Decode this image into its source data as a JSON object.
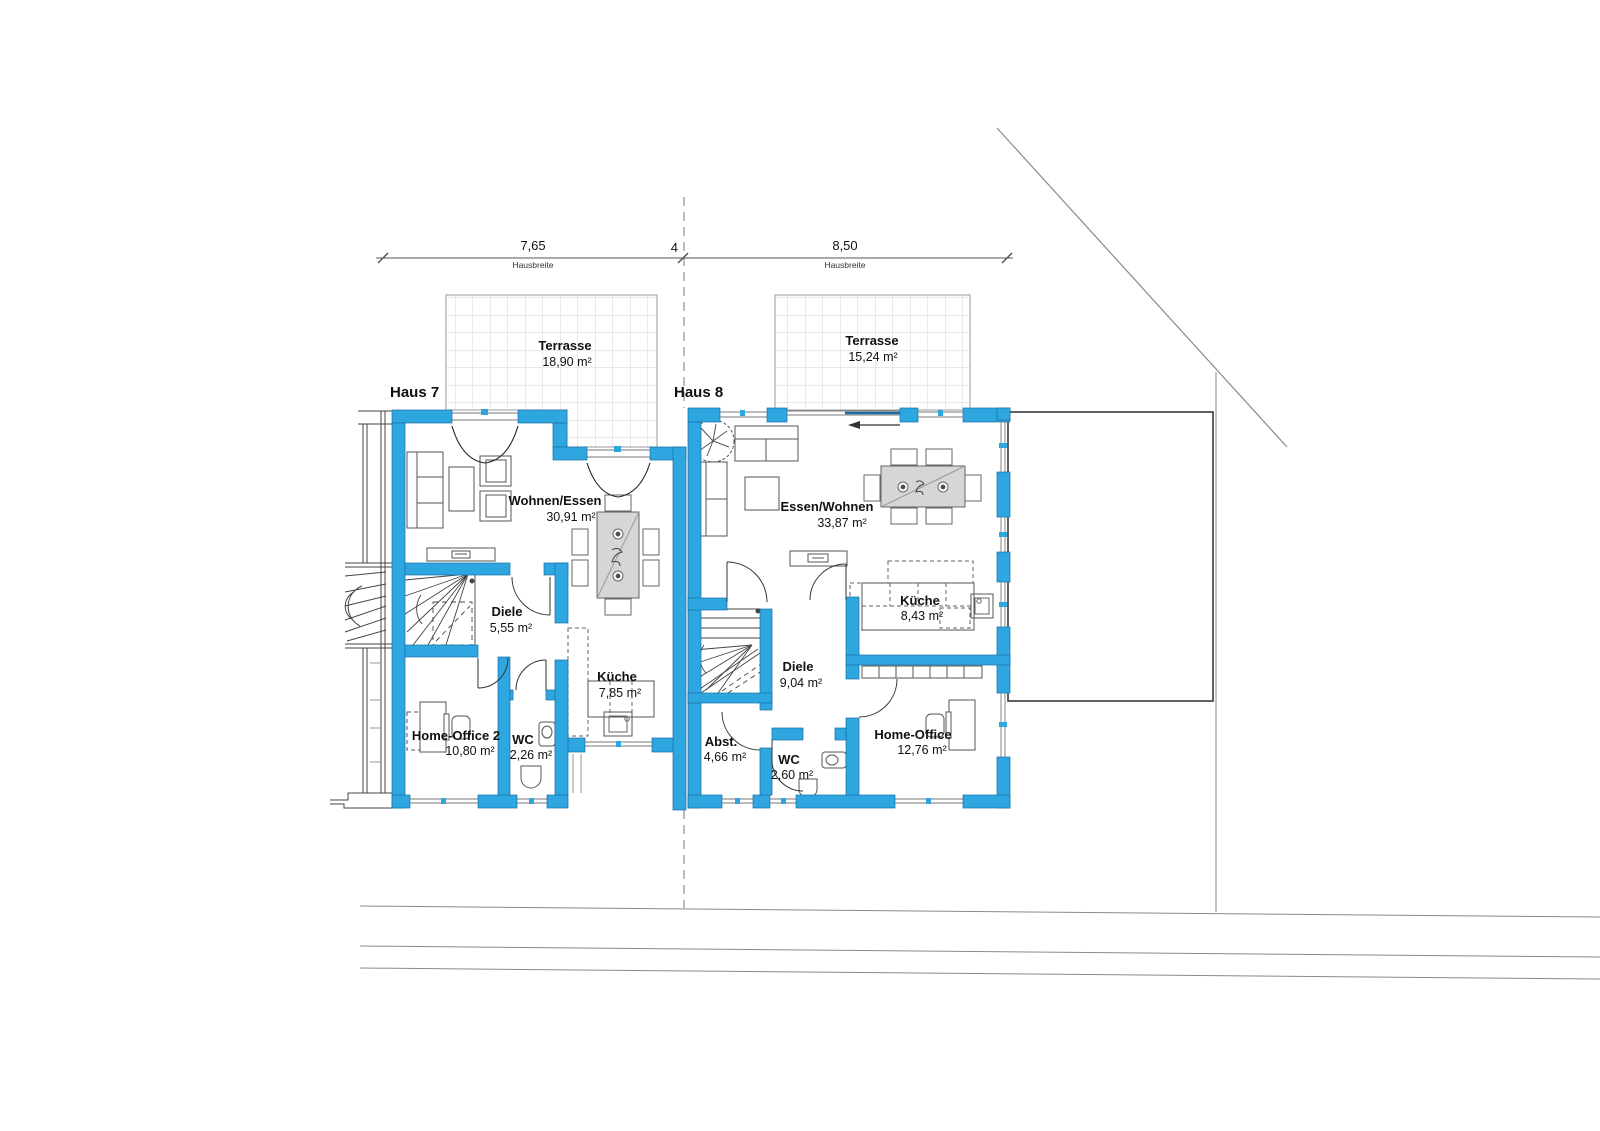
{
  "plan": {
    "dimensions": {
      "left": "7,65",
      "middle": "4",
      "right": "8,50",
      "left_sublabel": "Hausbreite",
      "right_sublabel": "Hausbreite"
    },
    "houses": [
      {
        "id": "haus7",
        "label": "Haus 7",
        "terrace": {
          "name": "Terrasse",
          "area": "18,90 m²"
        },
        "rooms": [
          {
            "name": "Wohnen/Essen",
            "area": "30,91 m²"
          },
          {
            "name": "Diele",
            "area": "5,55 m²"
          },
          {
            "name": "Küche",
            "area": "7,85 m²"
          },
          {
            "name": "Home-Office 2",
            "area": "10,80 m²"
          },
          {
            "name": "WC",
            "area": "2,26 m²"
          }
        ]
      },
      {
        "id": "haus8",
        "label": "Haus 8",
        "terrace": {
          "name": "Terrasse",
          "area": "15,24 m²"
        },
        "rooms": [
          {
            "name": "Essen/Wohnen",
            "area": "33,87 m²"
          },
          {
            "name": "Küche",
            "area": "8,43 m²"
          },
          {
            "name": "Diele",
            "area": "9,04 m²"
          },
          {
            "name": "Abst.",
            "area": "4,66 m²"
          },
          {
            "name": "WC",
            "area": "2,60 m²"
          },
          {
            "name": "Home-Office",
            "area": "12,76 m²"
          }
        ]
      }
    ],
    "colors": {
      "wall": "#2EA7E0",
      "wall_edge": "#1B6EA6"
    }
  }
}
